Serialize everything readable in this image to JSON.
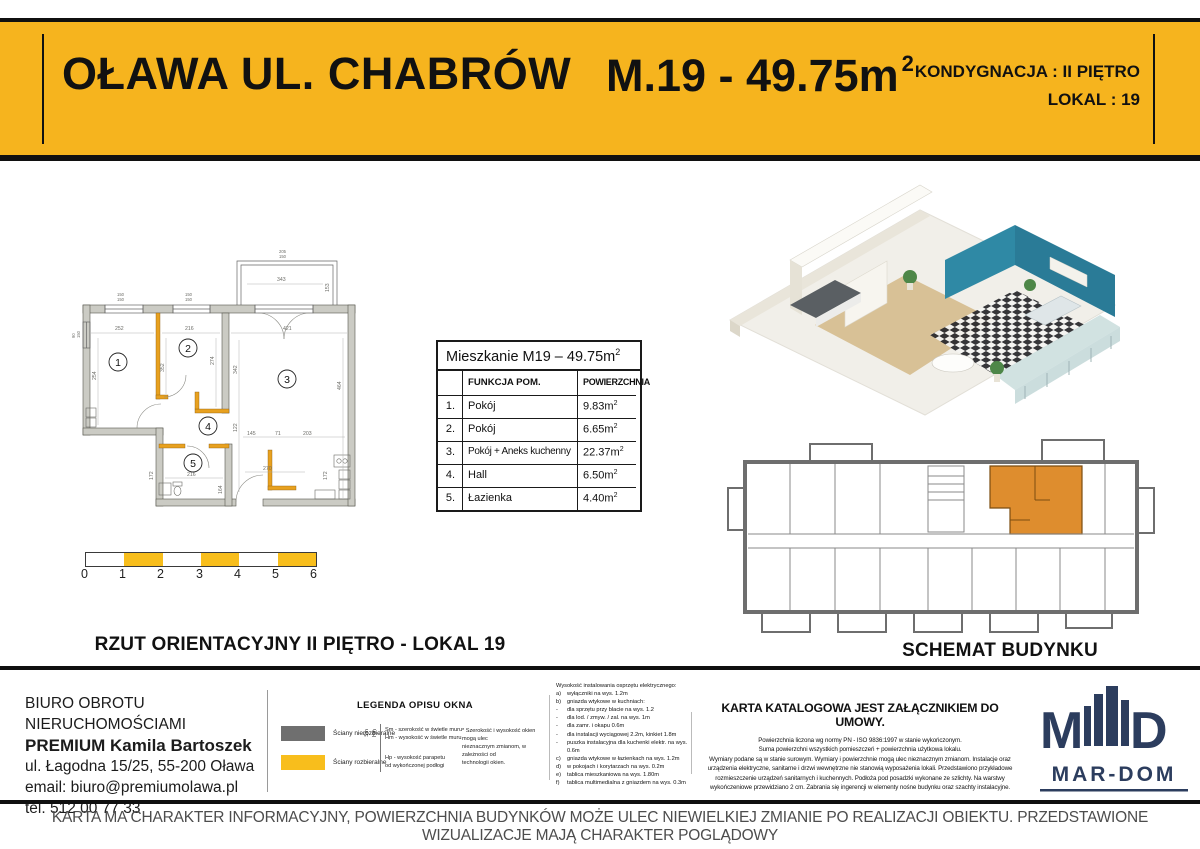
{
  "header": {
    "city": "OŁAWA UL. CHABRÓW",
    "unit": "M.19 - 49.75m",
    "unit_sup": "2",
    "line1": "KONDYGNACJA : II PIĘTRO",
    "line2": "LOKAL : 19"
  },
  "plan": {
    "caption": "RZUT ORIENTACYJNY II PIĘTRO - LOKAL 19",
    "rooms": [
      "1",
      "2",
      "3",
      "4",
      "5"
    ],
    "dims": {
      "balcony_w": "343",
      "balcony_d": "153",
      "w1a": "150",
      "w1b": "150",
      "w2a": "150",
      "w2b": "150",
      "w3a": "205",
      "w3b": "150",
      "lwa": "90",
      "lwb": "150",
      "r1w": "252",
      "r1h": "254",
      "r1i": "352",
      "r2w": "216",
      "r2h": "274",
      "r3w": "421",
      "r3h": "464",
      "r3i": "342",
      "h1": "122",
      "h2": "145",
      "h3": "71",
      "h4": "203",
      "b1": "216",
      "b2": "164",
      "b3": "172",
      "k1": "270",
      "k2": "172"
    }
  },
  "scalebar": {
    "ticks": [
      "0",
      "1",
      "2",
      "3",
      "4",
      "5",
      "6"
    ]
  },
  "table": {
    "title": "Mieszkanie M19 – 49.75m",
    "sup": "2",
    "col_func": "FUNKCJA POM.",
    "col_area": "POWIERZCHNIA",
    "rows": [
      {
        "no": "1.",
        "name": "Pokój",
        "area": "9.83m",
        "sup": "2"
      },
      {
        "no": "2.",
        "name": "Pokój",
        "area": "6.65m",
        "sup": "2"
      },
      {
        "no": "3.",
        "name": "Pokój + Aneks kuchenny",
        "area": "22.37m",
        "sup": "2"
      },
      {
        "no": "4.",
        "name": "Hall",
        "area": "6.50m",
        "sup": "2"
      },
      {
        "no": "5.",
        "name": "Łazienka",
        "area": "4.40m",
        "sup": "2"
      }
    ]
  },
  "schematic": {
    "caption": "SCHEMAT BUDYNKU"
  },
  "footer": {
    "contact": {
      "l1": "BIURO OBROTU NIERUCHOMOŚCIAMI",
      "l2": "PREMIUM Kamila Bartoszek",
      "l3": "ul. Łagodna 15/25, 55-200 Oława",
      "l4": "email: biuro@premiumolawa.pl",
      "l5": "tel. 512 00 77 33"
    },
    "legend": {
      "title": "LEGENDA OPISU OKNA",
      "item1": "Ściany nierozbieralne",
      "item2": "Ściany rozbieralne",
      "sym1": "Sm",
      "sym2": "Hm",
      "n1": "Sm - szerokość w świetle muru",
      "n2": "Hm - wysokość w świetle muru",
      "n3": "Hp - wysokość parapetu",
      "n4": "od wykończonej podłogi",
      "a1": "* Szerokość i wysokość okien mogą ulec",
      "a2": "nieznacznym zmianom, w zależności od",
      "a3": "technologii okien."
    },
    "electrical": {
      "title": "Wysokość instalowania osprzętu elektrycznego:",
      "items": [
        {
          "m": "a)",
          "t": "wyłączniki na wys. 1.2m"
        },
        {
          "m": "b)",
          "t": "gniazda wtykowe w kuchniach:"
        },
        {
          "m": "-",
          "t": "dla sprzętu przy blacie na wys. 1.2"
        },
        {
          "m": "-",
          "t": "dla lod. / zmyw. / zal. na wys. 1m"
        },
        {
          "m": "-",
          "t": "dla zamr. i okapu 0.6m"
        },
        {
          "m": "-",
          "t": "dla instalacji wyciągowej 2.2m, kinkiet 1.8m"
        },
        {
          "m": "-",
          "t": "puszka instalacyjna dla kuchenki elektr. na wys."
        },
        {
          "m": "",
          "t": "0.6m"
        },
        {
          "m": "c)",
          "t": "gniazda wtykowe w łazienkach na wys. 1.2m"
        },
        {
          "m": "d)",
          "t": "w pokojach i korytarzach na wys. 0.2m"
        },
        {
          "m": "e)",
          "t": "tablica mieszkaniowa na wys. 1.80m"
        },
        {
          "m": "f)",
          "t": "tablica multimedialna z gniazdem na wys. 0.3m"
        }
      ]
    },
    "karta": {
      "title": "KARTA KATALOGOWA JEST ZAŁĄCZNIKIEM DO UMOWY.",
      "lines": [
        "Powierzchnia liczona wg normy PN - ISO 9836:1997 w stanie wykończonym.",
        "Suma powierzchni wszystkich pomieszczeń + powierzchnia użytkowa lokalu.",
        "Wymiary podane są w stanie surowym. Wymiary i powierzchnie mogą ulec nieznacznym zmianom. Instalacje oraz",
        "urządzenia elektryczne, sanitarne i drzwi wewnętrzne nie stanowią wyposażenia lokali. Przedstawiono przykładowe",
        "rozmieszczenie urządzeń sanitarnych i kuchennych. Podłoża pod posadzki wykonane ze szlichty. Na warstwy",
        "wykończeniowe przewidziano 2 cm. Zabrania się ingerencji w elementy nośne budynku oraz szachty instalacyjne."
      ]
    },
    "logo": {
      "m": "M",
      "d": "D",
      "name": "MAR-DOM"
    }
  },
  "disclaimer": "KARTA MA CHARAKTER INFORMACYJNY, POWIERZCHNIA BUDYNKÓW MOŻE ULEC NIEWIELKIEJ ZMIANIE PO REALIZACJI OBIEKTU. PRZEDSTAWIONE WIZUALIZACJE MAJĄ CHARAKTER POGLĄDOWY",
  "colors": {
    "header_yellow": "#F6B41E",
    "scale_yellow": "#F8BE1C",
    "plan_orange": "#E8A11F",
    "unit_orange": "#DE8D2E",
    "logo_navy": "#2C3D5E",
    "legend_gray": "#6F6F6F"
  }
}
